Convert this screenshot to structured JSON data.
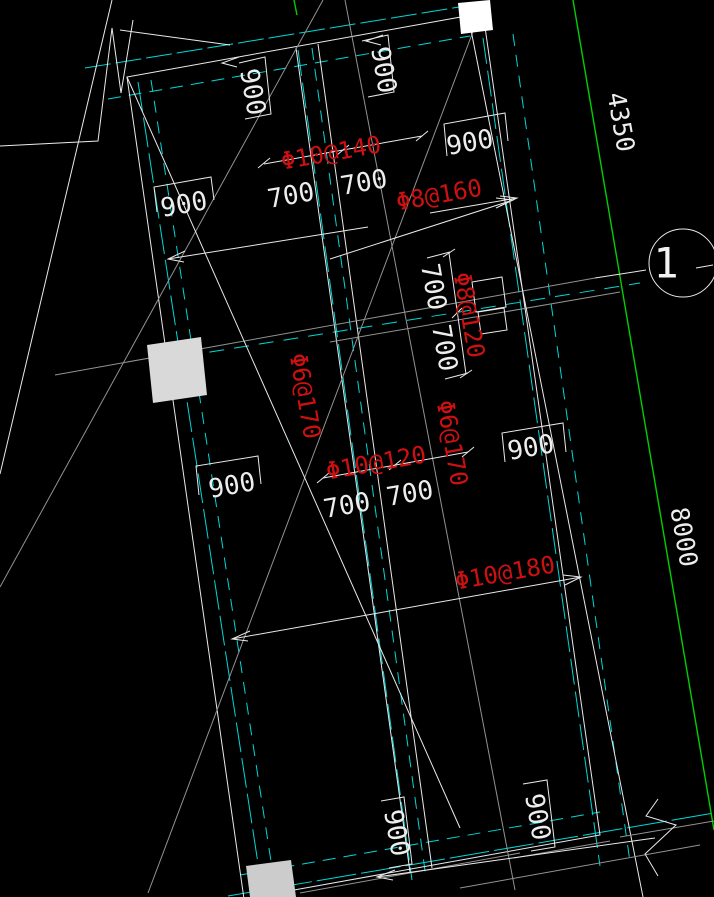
{
  "canvas": {
    "background": "#000000",
    "type": "cad-reinforcement-plan"
  },
  "colors": {
    "line_white": "#eaeaea",
    "line_gray": "#929292",
    "line_cyan": "#00d8d8",
    "line_green": "#00cf00",
    "text_red": "#cf1010",
    "column_fill": "#d9d9d9"
  },
  "grid": {
    "bubble_label": "1",
    "dim_4350": "4350",
    "dim_8000": "8000"
  },
  "rebar": {
    "top": "Φ10@140",
    "top_right": "Φ8@160",
    "right_vertical": "Φ8@120",
    "left_vertical": "Φ6@170",
    "middle": "Φ10@120",
    "middle_right_vertical": "Φ6@170",
    "bottom": "Φ10@180"
  },
  "dims": {
    "d900": [
      "900",
      "900",
      "900",
      "900",
      "900",
      "900",
      "900",
      "900"
    ],
    "d700": [
      "700",
      "700",
      "700",
      "700",
      "700",
      "700"
    ]
  }
}
